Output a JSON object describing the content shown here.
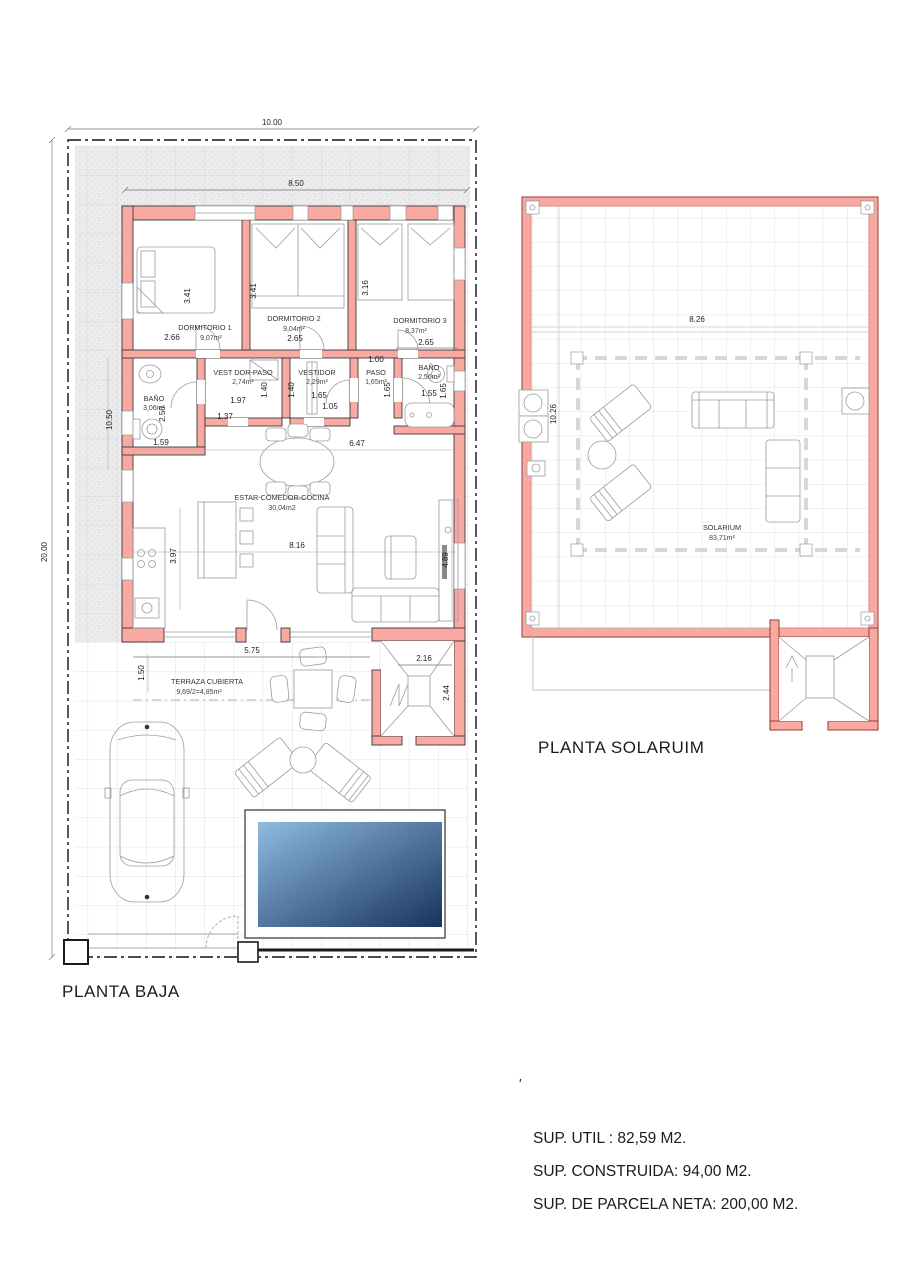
{
  "planta_baja": {
    "title": "PLANTA BAJA",
    "dim_plot_width": "10.00",
    "dim_plot_height": "20.00",
    "dim_house_width": "8.50",
    "dim_interior_height": "10.50",
    "dormitorio1": {
      "name": "DORMITORIO 1",
      "area": "9,07m²",
      "w": "2.66",
      "h": "3.41"
    },
    "dormitorio2": {
      "name": "DORMITORIO 2",
      "area": "9,04m²",
      "w": "2.65",
      "h": "3.41"
    },
    "dormitorio3": {
      "name": "DORMITORIO 3",
      "area": "8,37m²",
      "w": "2.65",
      "h": "3.16"
    },
    "banyo1": {
      "name": "BAÑO",
      "area": "3,06m²",
      "d1": "1.59",
      "d2": "2.50"
    },
    "vestidor_paso": {
      "name": "VEST DOR-PASO",
      "area": "2,74m²",
      "d1": "1.97",
      "d2": "1.37",
      "d3": "1.40"
    },
    "vestidor": {
      "name": "VESTIDOR",
      "area": "2,29m²",
      "d1": "1.65",
      "d2": "1.05",
      "d3": "1.40"
    },
    "paso": {
      "name": "PASO",
      "area": "1,65m²",
      "d1": "1.00",
      "d2": "1.65"
    },
    "banyo2": {
      "name": "BAÑO",
      "area": "2,56m²",
      "d1": "1.55",
      "d2": "1.65"
    },
    "estar": {
      "name": "ESTAR-COMEDOR-COCINA",
      "area": "30,04m2",
      "d1": "6.47",
      "d2": "8.16",
      "d3": "3.97",
      "d4": "4.89"
    },
    "terraza": {
      "name": "TERRAZA CUBIERTA",
      "area": "9,69/2=4,85m²",
      "d1": "5.75",
      "d2": "1.50"
    },
    "escalera": {
      "d1": "2.16",
      "d2": "2.44"
    }
  },
  "planta_solarium": {
    "title": "PLANTA SOLARUIM",
    "room": {
      "name": "SOLARIUM",
      "area": "83,71m²"
    },
    "dim_width": "8.26",
    "dim_height": "10.26"
  },
  "summary": {
    "tick": "'",
    "sup_util": "SUP. UTIL : 82,59 M2.",
    "sup_construida": "SUP. CONSTRUIDA: 94,00 M2.",
    "sup_parcela": "SUP. DE PARCELA NETA: 200,00 M2."
  },
  "colors": {
    "wall_fill": "#F7A9A2",
    "wall_stroke_baja": "#3A3A3A",
    "wall_stroke_solarium": "#A14A44",
    "grid_line": "#D8D8D8",
    "plot_boundary": "#111111",
    "pool_light": "#8FBBE0",
    "pool_dark": "#17335F"
  }
}
